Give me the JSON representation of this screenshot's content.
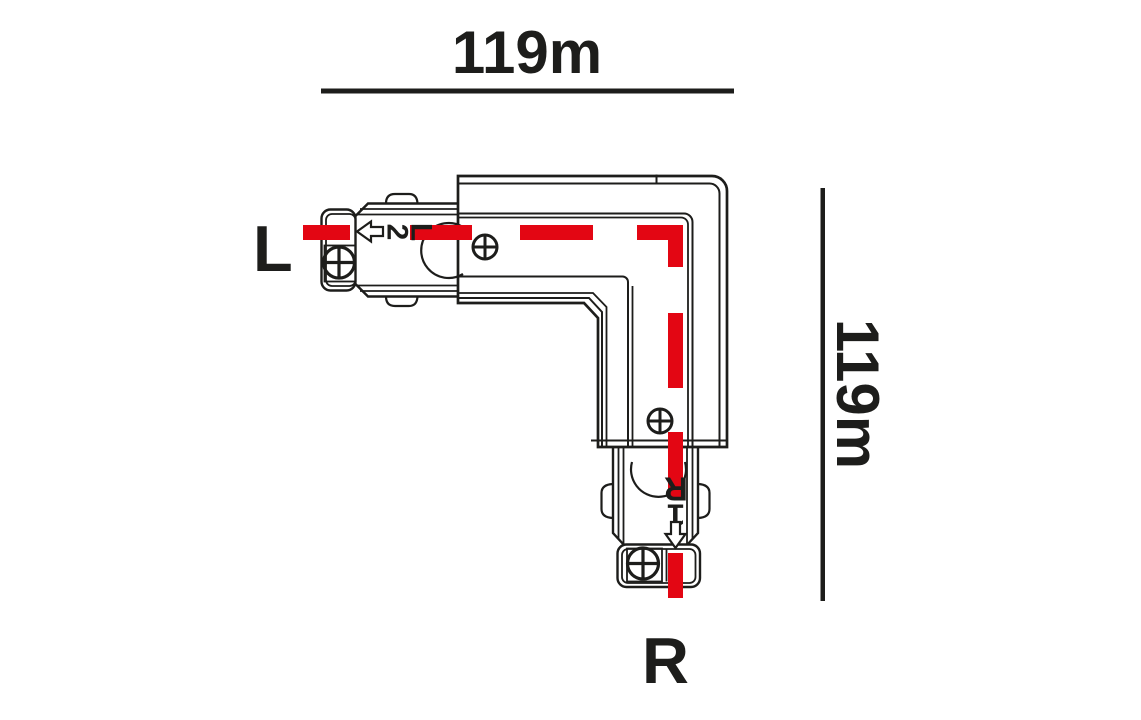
{
  "diagram": {
    "title_implicit": "L-shaped 3-circuit track corner connector technical drawing",
    "dimensions": {
      "top": "119m",
      "right": "119m"
    },
    "labels": {
      "left_end": "L",
      "right_end": "R"
    },
    "connector": {
      "left_plug": {
        "circuit": "2",
        "marking": "L"
      },
      "bottom_plug": {
        "circuit": "1",
        "marking": "R"
      }
    },
    "icons": [
      "left-arrow-icon",
      "down-arrow-icon",
      "screw-icon-body-left",
      "screw-icon-body-bottom",
      "screw-icon-left-cap",
      "screw-icon-bottom-cap"
    ],
    "colors": {
      "line": "#1d1d1b",
      "circuit_red": "#e30613",
      "background": "#ffffff"
    }
  }
}
